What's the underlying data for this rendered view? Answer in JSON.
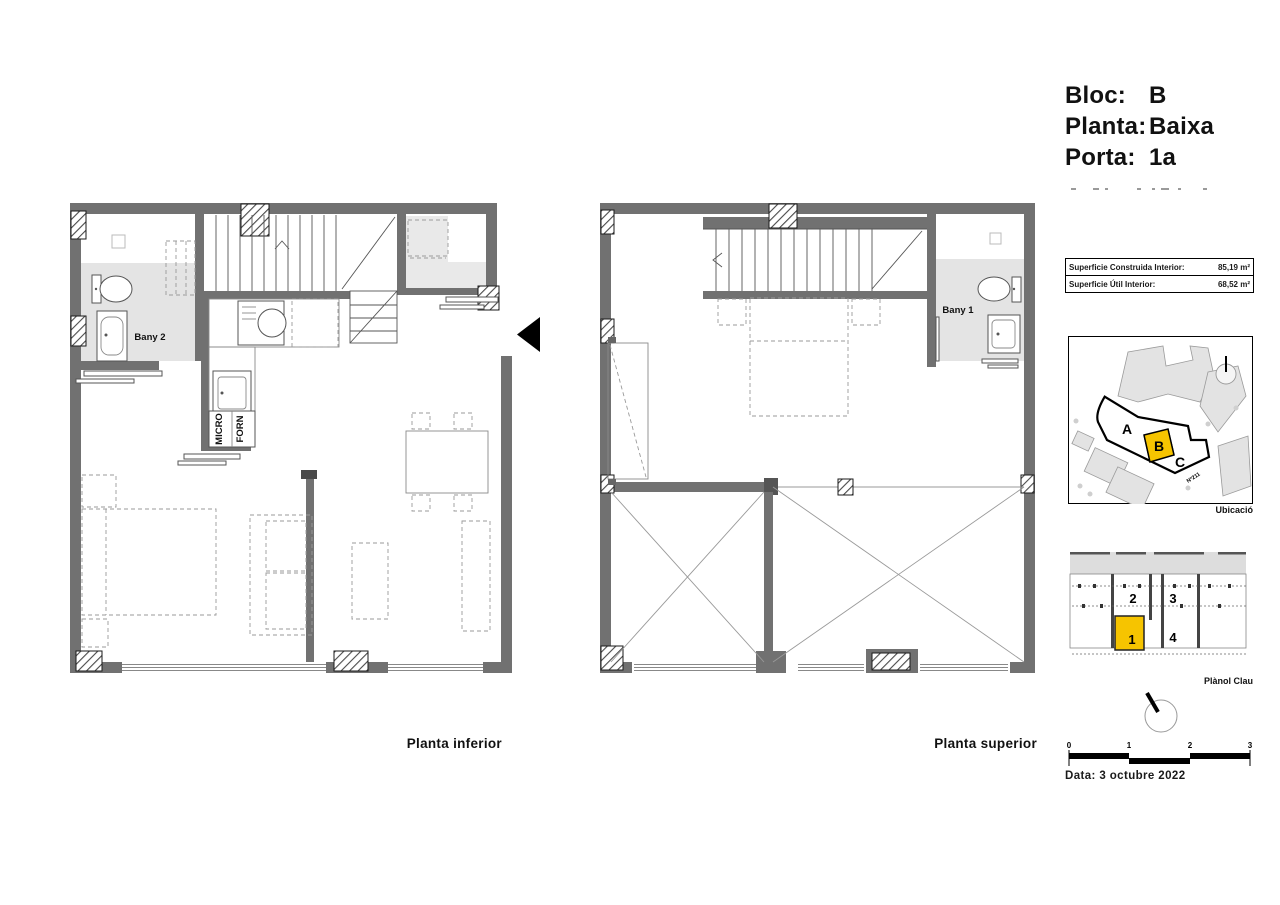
{
  "title_block": {
    "rows": [
      {
        "label": "Bloc:",
        "value": "B"
      },
      {
        "label": "Planta:",
        "value": "Baixa"
      },
      {
        "label": "Porta:",
        "value": "1a"
      }
    ]
  },
  "area_table": {
    "rows": [
      {
        "label": "Superficie Construida Interior:",
        "value": "85,19 m²"
      },
      {
        "label": "Superficie Útil Interior:",
        "value": "68,52 m²"
      }
    ]
  },
  "site_map": {
    "caption": "Ubicació",
    "block_labels": {
      "a": "A",
      "b": "B",
      "c": "C"
    },
    "street_label": "Nº211",
    "highlight_color": "#F6C400"
  },
  "key_plan": {
    "caption": "Plànol Clau",
    "unit_labels": {
      "u1": "1",
      "u2": "2",
      "u3": "3",
      "u4": "4"
    },
    "highlighted_unit": "1"
  },
  "plan_inferior": {
    "caption": "Planta inferior",
    "labels": {
      "bany2": "Bany 2",
      "micro": "MICRO",
      "forn": "FORN"
    }
  },
  "plan_superior": {
    "caption": "Planta superior",
    "labels": {
      "bany1": "Bany 1"
    }
  },
  "scale_bar": {
    "ticks": [
      "0",
      "1",
      "2",
      "3"
    ]
  },
  "footer": {
    "date": "Data: 3 octubre 2022"
  },
  "colors": {
    "wall": "#717171",
    "room_shade": "#E4E4E4",
    "highlight": "#F6C400",
    "map_building": "#E3E3E3",
    "line": "#1A1A1A"
  }
}
